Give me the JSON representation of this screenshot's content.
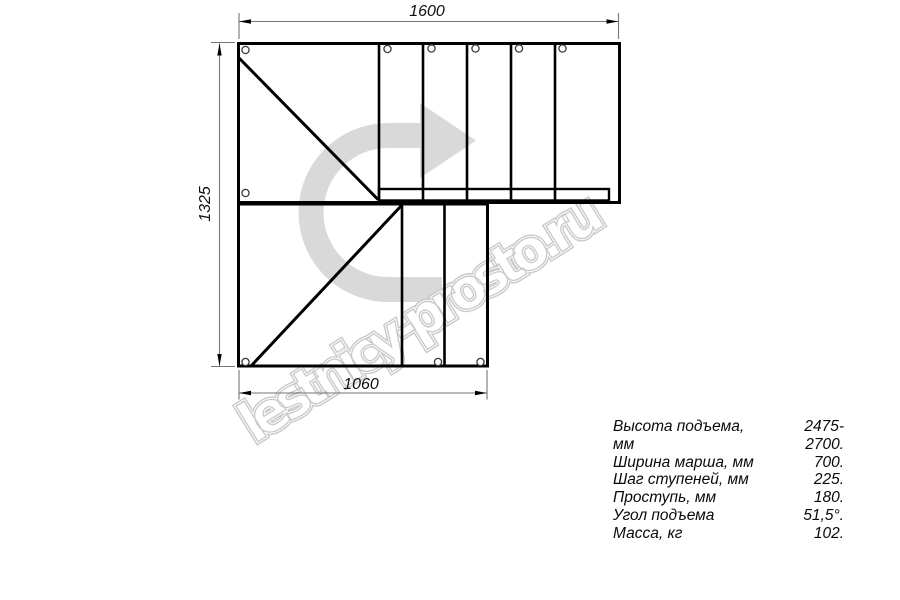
{
  "drawing": {
    "watermark": "lestnicy-prosto.ru",
    "dimensions": {
      "top_width_mm": "1600",
      "left_height_mm": "1325",
      "bottom_width_mm": "1060"
    },
    "specs": [
      {
        "label": "Высота подъема, мм",
        "value": "2475-2700."
      },
      {
        "label": "Ширина марша, мм",
        "value": "700."
      },
      {
        "label": "Шаг ступеней, мм",
        "value": "225."
      },
      {
        "label": "Проступь, мм",
        "value": "180."
      },
      {
        "label": "Угол подъема",
        "value": "51,5°."
      },
      {
        "label": "Масса, кг",
        "value": "102."
      }
    ],
    "colors": {
      "line": "#000000",
      "dimension": "#757575",
      "arrow_fill": "#d9d9d9",
      "watermark_outline": "#c7c7c7"
    }
  }
}
